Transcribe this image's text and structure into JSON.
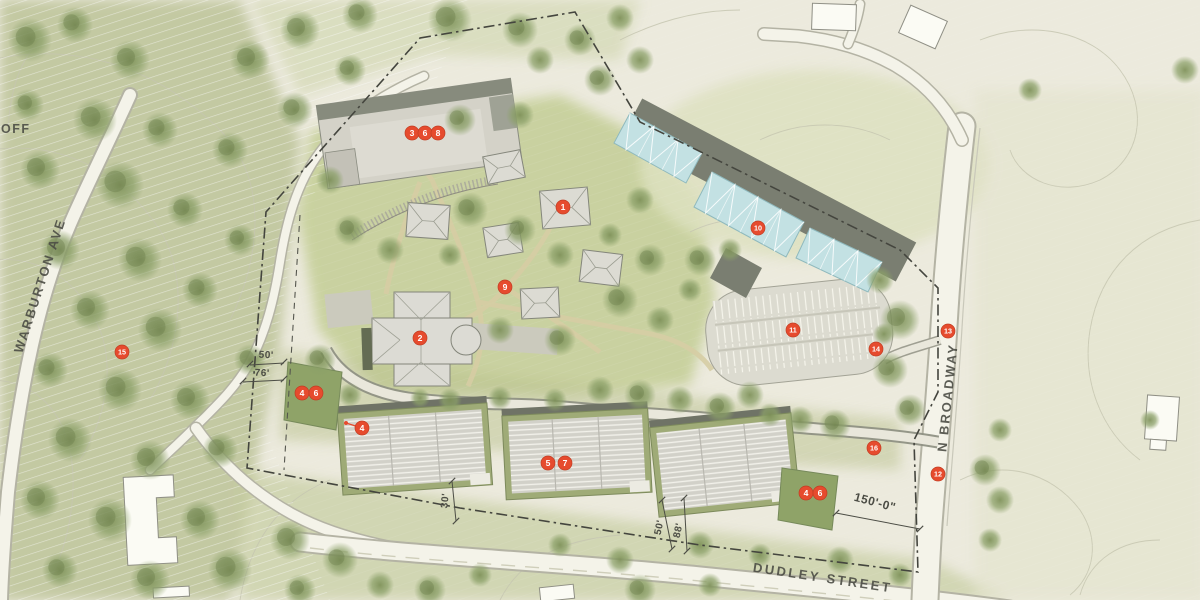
{
  "plan": {
    "street_labels": [
      {
        "text": "OFF"
      },
      {
        "text": "WARBURTON AVE"
      },
      {
        "text": "N BROADWAY"
      },
      {
        "text": "DUDLEY STREET"
      }
    ],
    "dimensions": [
      {
        "text": "50'"
      },
      {
        "text": "76'"
      },
      {
        "text": "30'"
      },
      {
        "text": "50'"
      },
      {
        "text": "88'"
      },
      {
        "text": "150'-0\""
      }
    ],
    "markers": [
      {
        "label": "3",
        "x": 412,
        "y": 133
      },
      {
        "label": "6",
        "x": 425,
        "y": 133
      },
      {
        "label": "8",
        "x": 438,
        "y": 133
      },
      {
        "label": "1",
        "x": 563,
        "y": 207
      },
      {
        "label": "10",
        "x": 758,
        "y": 228
      },
      {
        "label": "9",
        "x": 505,
        "y": 287
      },
      {
        "label": "2",
        "x": 420,
        "y": 338
      },
      {
        "label": "15",
        "x": 122,
        "y": 352
      },
      {
        "label": "13",
        "x": 948,
        "y": 331
      },
      {
        "label": "14",
        "x": 876,
        "y": 349
      },
      {
        "label": "11",
        "x": 793,
        "y": 330
      },
      {
        "label": "4",
        "x": 302,
        "y": 393
      },
      {
        "label": "6",
        "x": 316,
        "y": 393
      },
      {
        "label": "4",
        "x": 362,
        "y": 428,
        "leader": {
          "x": 346,
          "y": 423
        }
      },
      {
        "label": "5",
        "x": 548,
        "y": 463
      },
      {
        "label": "7",
        "x": 565,
        "y": 463
      },
      {
        "label": "16",
        "x": 874,
        "y": 448
      },
      {
        "label": "12",
        "x": 938,
        "y": 474
      },
      {
        "label": "4",
        "x": 806,
        "y": 493
      },
      {
        "label": "6",
        "x": 820,
        "y": 493
      }
    ],
    "colors": {
      "marker": "#e64b2e",
      "marker_text": "#ffffff",
      "label_text": "#4c4d45",
      "background": "#eceadd",
      "lawn": "#c7d09c",
      "canopy": "#8b9d68",
      "glass_building": "#c3e1e3",
      "roof_gray": "#d7d6ce",
      "roof_dark": "#75796c",
      "road": "#f4f3e9"
    }
  }
}
